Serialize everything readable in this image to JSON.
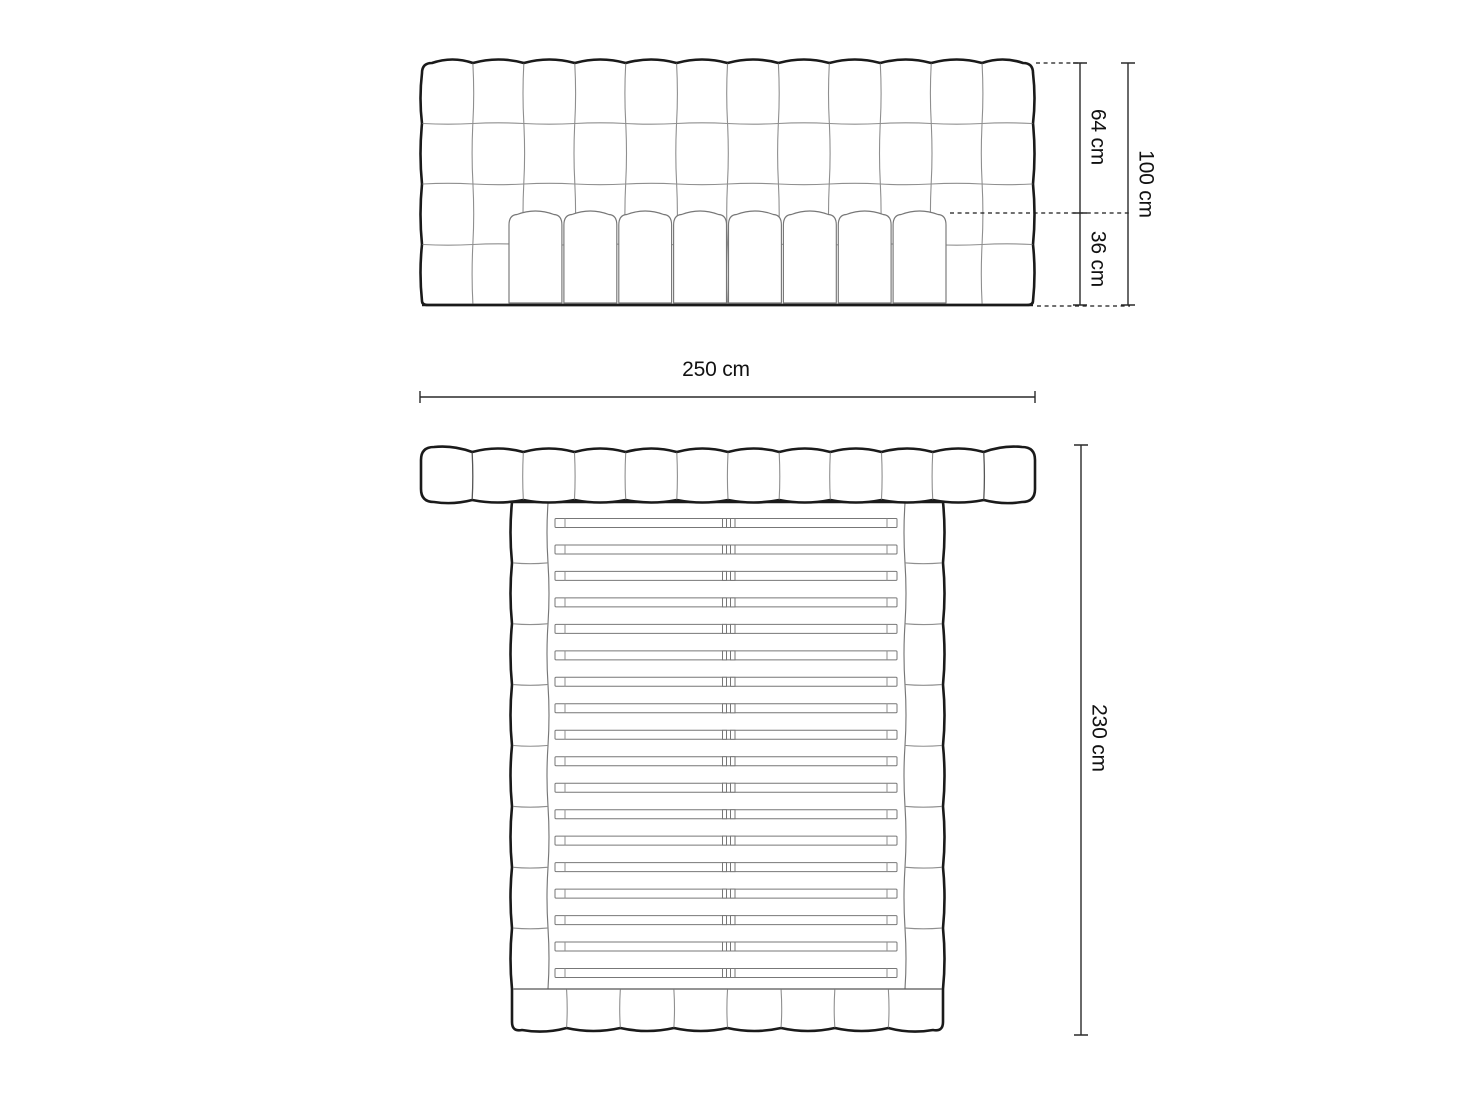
{
  "dimensions": {
    "front_upper_height": {
      "label": "64 cm",
      "value": 64,
      "unit": "cm"
    },
    "front_lower_height": {
      "label": "36 cm",
      "value": 36,
      "unit": "cm"
    },
    "front_total_height": {
      "label": "100 cm",
      "value": 100,
      "unit": "cm"
    },
    "overall_width": {
      "label": "250 cm",
      "value": 250,
      "unit": "cm"
    },
    "overall_length": {
      "label": "230 cm",
      "value": 230,
      "unit": "cm"
    }
  },
  "structure": {
    "headboard_columns": 12,
    "headboard_rows": 4,
    "mattress_front_cushions": 8,
    "slat_count": 18,
    "side_rail_segments": 8,
    "footer_segments": 8
  },
  "colors": {
    "background": "#ffffff",
    "outline": "#1a1a1a",
    "tuft_line": "#8f8f8f",
    "detail_line": "#777777",
    "dimension": "#2a2a2a",
    "text": "#111111"
  }
}
